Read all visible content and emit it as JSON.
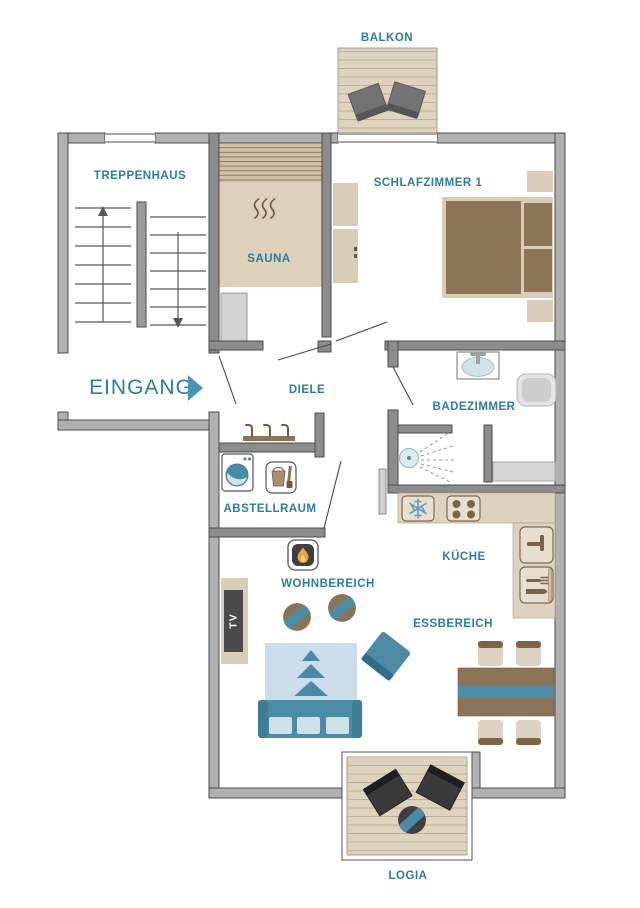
{
  "page": {
    "type": "apartment-floor-plan",
    "background": "#ffffff"
  },
  "colors": {
    "label": "#2b7d9d",
    "accent": "#4796b4",
    "wall": "#b0b0b0",
    "wallInterior": "#8c8c8c",
    "wallStroke": "#4c4c4c",
    "deck": "#ded3bd",
    "deckLine": "#bcb097",
    "saunaBench": "#cfc2a8",
    "saunaStripe": "#8d7c63",
    "saunaPlatform": "#ddd1bc",
    "tan": "#d9cdb8",
    "counter": "#ddd2c0",
    "counterEdge": "#7a6a52",
    "brown": "#8b7457",
    "darkBrown": "#6e5b43",
    "teal": "#4b8ba4",
    "tealDark": "#2f6f8c",
    "rug": "#c9dee8",
    "pillow": "#cfe0e8",
    "grayItem": "#d2d2d2",
    "darkChair": "#3a3a3a",
    "flame": "#e8a33d"
  },
  "rooms": {
    "balkon": {
      "label": "BALKON"
    },
    "treppenhaus": {
      "label": "TREPPENHAUS"
    },
    "schlafzimmer1": {
      "label": "SCHLAFZIMMER 1"
    },
    "sauna": {
      "label": "SAUNA"
    },
    "eingang": {
      "label": "EINGANG"
    },
    "diele": {
      "label": "DIELE"
    },
    "badezimmer": {
      "label": "BADEZIMMER"
    },
    "abstellraum": {
      "label": "ABSTELLRAUM"
    },
    "kueche": {
      "label": "KÜCHE"
    },
    "wohnbereich": {
      "label": "WOHNBEREICH"
    },
    "essbereich": {
      "label": "ESSBEREICH"
    },
    "logia": {
      "label": "LOGIA"
    }
  },
  "labels": {
    "tv": "TV"
  },
  "furniture": {
    "balkon": [
      "two outdoor chairs",
      "wood deck"
    ],
    "schlafzimmer1": [
      "double bed",
      "two nightstands",
      "wardrobe"
    ],
    "sauna": [
      "sauna bench",
      "heater",
      "heat-waves symbol"
    ],
    "badezimmer": [
      "washbasin",
      "toilet",
      "shower",
      "shelf"
    ],
    "abstellraum": [
      "washing machine",
      "cleaning bucket"
    ],
    "diele": [
      "coat rack with three hooks"
    ],
    "kueche": [
      "freezer",
      "stove with four burners",
      "kitchen sink",
      "cutlery drawer"
    ],
    "essbereich": [
      "dining table with runner",
      "four stools"
    ],
    "wohnbereich": [
      "fireplace",
      "tv sideboard",
      "two round chairs",
      "rug with triangles",
      "sofa with three cushions",
      "armchair"
    ],
    "logia": [
      "two deck chairs",
      "round table",
      "wood deck"
    ]
  }
}
